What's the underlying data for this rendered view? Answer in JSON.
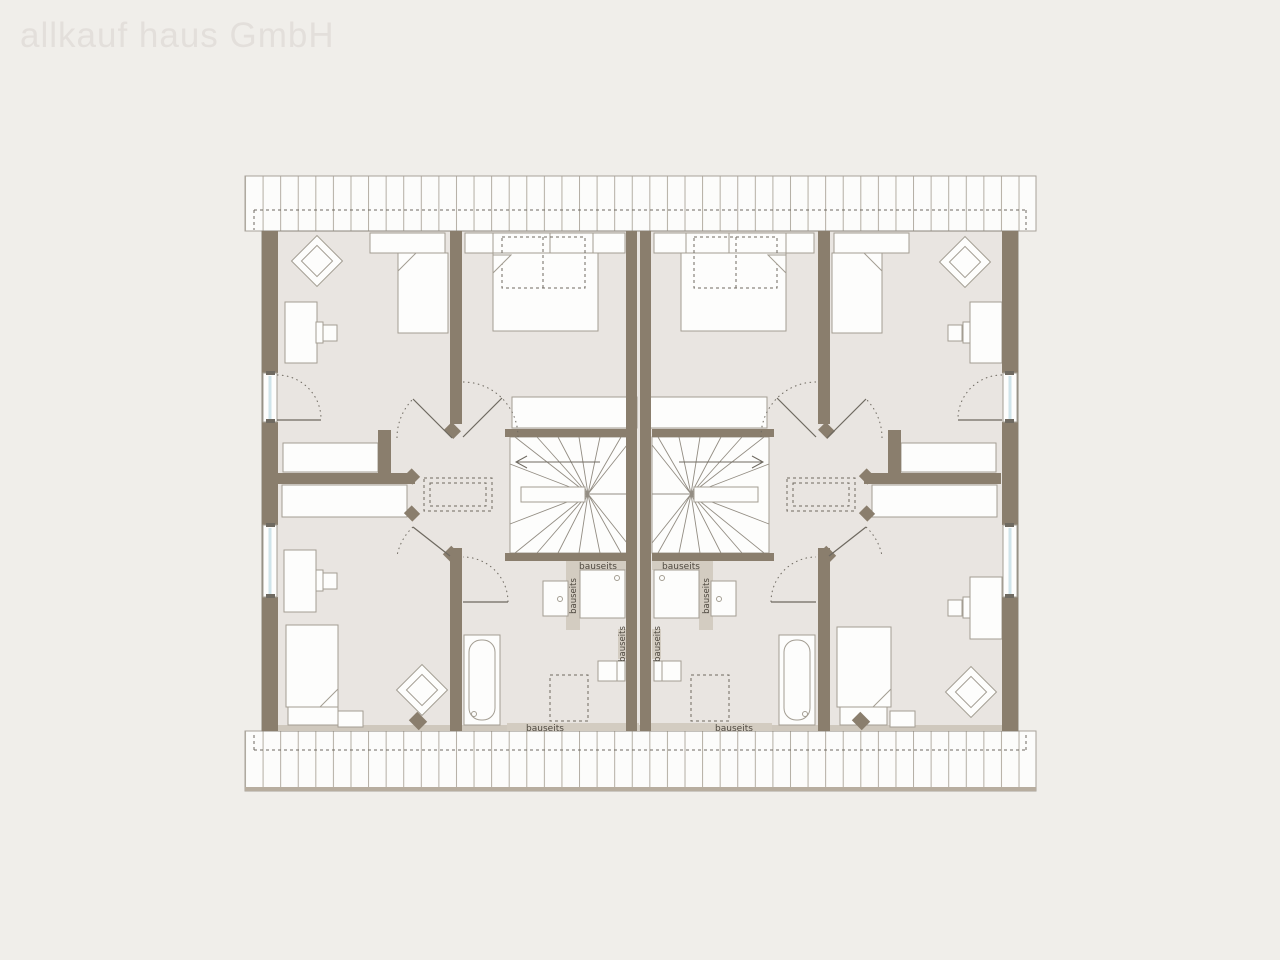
{
  "watermark": "allkauf haus GmbH",
  "plan": {
    "type": "floor-plan-attic-storey",
    "units": 2,
    "labels": {
      "bauseits": "bauseits"
    },
    "colors": {
      "background": "#f0eeea",
      "floor": "#e9e5e1",
      "wall": "#8a7e6d",
      "onsite_strip": "#d3ccc1",
      "furniture_fill": "#fdfdfc",
      "furniture_stroke": "#a39d92",
      "dashed_lines": "#6e6960",
      "window_glass": "#cfe4ea",
      "hatch_stripe": "#b4aea4",
      "label_text": "#4e483f",
      "watermark_text": "#e3dfdb"
    }
  }
}
